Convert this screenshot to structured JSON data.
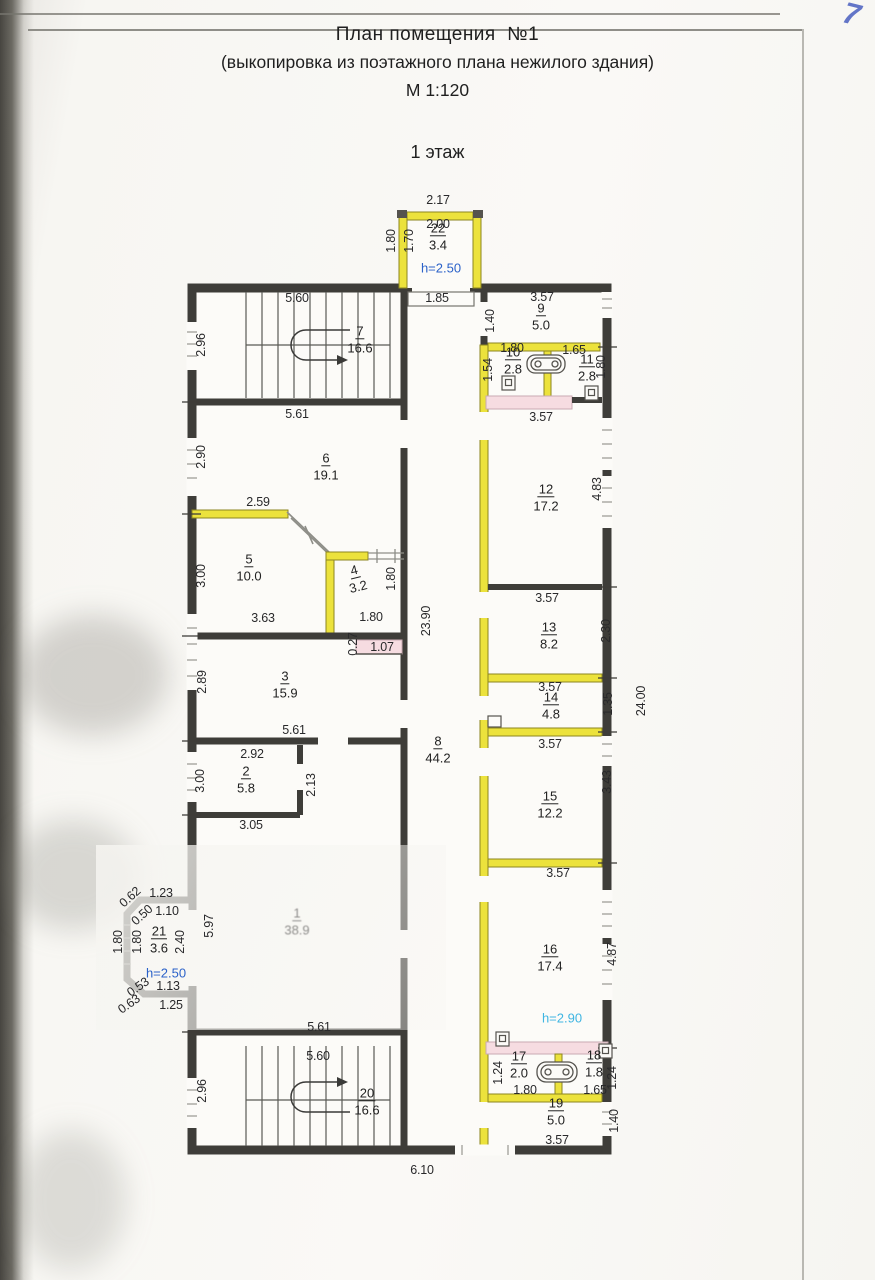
{
  "page": {
    "handwritten_page_number": "7"
  },
  "title": {
    "line1": "План помещения  №1",
    "line2": "(выкопировка из поэтажного плана нежилого здания)",
    "scale": "М 1:120",
    "floor": "1 этаж"
  },
  "colors": {
    "wall": "#3e3d39",
    "new_wall_yellow": "#ece23c",
    "demolition_pink": "#f6dce1",
    "height_blue": "#2b62c9",
    "height_cyan": "#3fb5e2",
    "pen_blue": "#4a5fc0"
  },
  "plan": {
    "rooms": [
      {
        "num": "22",
        "area": "3.4",
        "x": 438,
        "y": 236
      },
      {
        "num": "7",
        "area": "16.6",
        "x": 360,
        "y": 339
      },
      {
        "num": "9",
        "area": "5.0",
        "x": 541,
        "y": 316
      },
      {
        "num": "10",
        "area": "2.8",
        "x": 513,
        "y": 360
      },
      {
        "num": "11",
        "area": "2.8",
        "x": 587,
        "y": 367
      },
      {
        "num": "6",
        "area": "19.1",
        "x": 326,
        "y": 466
      },
      {
        "num": "12",
        "area": "17.2",
        "x": 546,
        "y": 497
      },
      {
        "num": "5",
        "area": "10.0",
        "x": 249,
        "y": 567
      },
      {
        "num": "4",
        "area": "3.2",
        "x": 356,
        "y": 578,
        "rot": -14
      },
      {
        "num": "13",
        "area": "8.2",
        "x": 549,
        "y": 635
      },
      {
        "num": "3",
        "area": "15.9",
        "x": 285,
        "y": 684
      },
      {
        "num": "14",
        "area": "4.8",
        "x": 551,
        "y": 705
      },
      {
        "num": "8",
        "area": "44.2",
        "x": 438,
        "y": 749
      },
      {
        "num": "2",
        "area": "5.8",
        "x": 246,
        "y": 779
      },
      {
        "num": "15",
        "area": "12.2",
        "x": 550,
        "y": 804
      },
      {
        "num": "1",
        "area": "38.9",
        "x": 297,
        "y": 921,
        "faint": true
      },
      {
        "num": "21",
        "area": "3.6",
        "x": 159,
        "y": 939
      },
      {
        "num": "16",
        "area": "17.4",
        "x": 550,
        "y": 957
      },
      {
        "num": "17",
        "area": "2.0",
        "x": 519,
        "y": 1064
      },
      {
        "num": "18",
        "area": "1.8",
        "x": 594,
        "y": 1063
      },
      {
        "num": "20",
        "area": "16.6",
        "x": 367,
        "y": 1101
      },
      {
        "num": "19",
        "area": "5.0",
        "x": 556,
        "y": 1111
      }
    ],
    "dimensions": [
      {
        "t": "2.17",
        "x": 438,
        "y": 200
      },
      {
        "t": "2.00",
        "x": 438,
        "y": 224
      },
      {
        "t": "1.80",
        "x": 391,
        "y": 241,
        "r": -90
      },
      {
        "t": "1.70",
        "x": 409,
        "y": 241,
        "r": -90
      },
      {
        "t": "1.85",
        "x": 437,
        "y": 298
      },
      {
        "t": "5.60",
        "x": 297,
        "y": 298
      },
      {
        "t": "3.57",
        "x": 542,
        "y": 297
      },
      {
        "t": "1.40",
        "x": 490,
        "y": 321,
        "r": -90
      },
      {
        "t": "2.96",
        "x": 201,
        "y": 345,
        "r": -90
      },
      {
        "t": "1.80",
        "x": 512,
        "y": 348
      },
      {
        "t": "1.65",
        "x": 574,
        "y": 350
      },
      {
        "t": "1.54",
        "x": 488,
        "y": 370,
        "r": -90
      },
      {
        "t": "1.80",
        "x": 601,
        "y": 367,
        "r": -90
      },
      {
        "t": "5.61",
        "x": 297,
        "y": 414
      },
      {
        "t": "3.57",
        "x": 541,
        "y": 417
      },
      {
        "t": "2.90",
        "x": 201,
        "y": 457,
        "r": -90
      },
      {
        "t": "4.83",
        "x": 597,
        "y": 489,
        "r": -90
      },
      {
        "t": "2.59",
        "x": 258,
        "y": 502
      },
      {
        "t": "3.00",
        "x": 201,
        "y": 576,
        "r": -90
      },
      {
        "t": "1.80",
        "x": 391,
        "y": 579,
        "r": -90
      },
      {
        "t": "23.90",
        "x": 426,
        "y": 621,
        "r": -90
      },
      {
        "t": "3.63",
        "x": 263,
        "y": 618
      },
      {
        "t": "1.80",
        "x": 371,
        "y": 617
      },
      {
        "t": "0.27",
        "x": 353,
        "y": 644,
        "r": -90
      },
      {
        "t": "1.07",
        "x": 382,
        "y": 647
      },
      {
        "t": "3.57",
        "x": 547,
        "y": 598
      },
      {
        "t": "2.30",
        "x": 606,
        "y": 631,
        "r": -90
      },
      {
        "t": "2.89",
        "x": 202,
        "y": 682,
        "r": -90
      },
      {
        "t": "3.57",
        "x": 550,
        "y": 687
      },
      {
        "t": "1.35",
        "x": 608,
        "y": 704,
        "r": -90
      },
      {
        "t": "24.00",
        "x": 641,
        "y": 701,
        "r": -90
      },
      {
        "t": "5.61",
        "x": 294,
        "y": 730
      },
      {
        "t": "3.57",
        "x": 550,
        "y": 744
      },
      {
        "t": "2.92",
        "x": 252,
        "y": 754
      },
      {
        "t": "3.00",
        "x": 200,
        "y": 781,
        "r": -90
      },
      {
        "t": "2.13",
        "x": 311,
        "y": 785,
        "r": -90
      },
      {
        "t": "3.43",
        "x": 607,
        "y": 782,
        "r": -90
      },
      {
        "t": "3.05",
        "x": 251,
        "y": 825
      },
      {
        "t": "3.57",
        "x": 558,
        "y": 873
      },
      {
        "t": "0.62",
        "x": 130,
        "y": 897,
        "r": -42
      },
      {
        "t": "1.23",
        "x": 161,
        "y": 893
      },
      {
        "t": "0.50",
        "x": 142,
        "y": 915,
        "r": -42
      },
      {
        "t": "1.10",
        "x": 167,
        "y": 911
      },
      {
        "t": "1.80",
        "x": 118,
        "y": 942,
        "r": -90
      },
      {
        "t": "1.80",
        "x": 137,
        "y": 942,
        "r": -90
      },
      {
        "t": "2.40",
        "x": 180,
        "y": 942,
        "r": -90
      },
      {
        "t": "5.97",
        "x": 209,
        "y": 926,
        "r": -90
      },
      {
        "t": "4.87",
        "x": 612,
        "y": 954,
        "r": -90
      },
      {
        "t": "0.53",
        "x": 138,
        "y": 987,
        "r": -35
      },
      {
        "t": "1.13",
        "x": 168,
        "y": 986
      },
      {
        "t": "0.63",
        "x": 129,
        "y": 1004,
        "r": -35
      },
      {
        "t": "1.25",
        "x": 171,
        "y": 1005
      },
      {
        "t": "5.61",
        "x": 319,
        "y": 1027
      },
      {
        "t": "5.60",
        "x": 318,
        "y": 1056
      },
      {
        "t": "2.96",
        "x": 202,
        "y": 1091,
        "r": -90
      },
      {
        "t": "1.24",
        "x": 498,
        "y": 1073,
        "r": -90
      },
      {
        "t": "1.80",
        "x": 525,
        "y": 1090
      },
      {
        "t": "1.65",
        "x": 595,
        "y": 1090
      },
      {
        "t": "1.24",
        "x": 612,
        "y": 1078,
        "r": -90
      },
      {
        "t": "1.40",
        "x": 614,
        "y": 1121,
        "r": -90
      },
      {
        "t": "3.57",
        "x": 557,
        "y": 1140
      },
      {
        "t": "6.10",
        "x": 422,
        "y": 1170
      }
    ],
    "heights": [
      {
        "t": "h=2.50",
        "x": 441,
        "y": 268,
        "c": "blue"
      },
      {
        "t": "h=2.50",
        "x": 166,
        "y": 973,
        "c": "blue"
      },
      {
        "t": "h=2.90",
        "x": 562,
        "y": 1018,
        "c": "cyan"
      }
    ]
  }
}
